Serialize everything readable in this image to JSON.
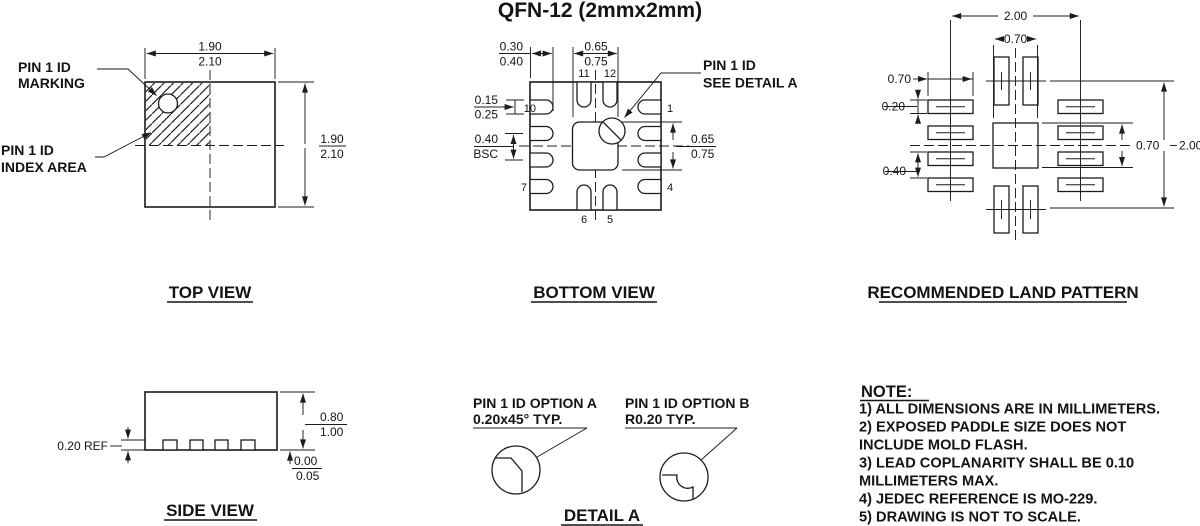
{
  "colors": {
    "ink": "#1c1c1c",
    "background": "#ffffff"
  },
  "title": "QFN-12 (2mmx2mm)",
  "top_view": {
    "title": "TOP VIEW",
    "width_min": "1.90",
    "width_max": "2.10",
    "height_min": "1.90",
    "height_max": "2.10",
    "marking_label_1": "PIN 1 ID",
    "marking_label_2": "MARKING",
    "index_label_1": "PIN 1 ID",
    "index_label_2": "INDEX AREA"
  },
  "bottom_view": {
    "title": "BOTTOM VIEW",
    "lead_length_min": "0.30",
    "lead_length_max": "0.40",
    "epad_width_min": "0.65",
    "epad_width_max": "0.75",
    "lead_width_min": "0.15",
    "lead_width_max": "0.25",
    "pitch_value": "0.40",
    "pitch_qualifier": "BSC",
    "epad_height_min": "0.65",
    "epad_height_max": "0.75",
    "pin1_label_1": "PIN 1 ID",
    "pin1_label_2": "SEE DETAIL A",
    "pins": {
      "n1": "1",
      "n4": "4",
      "n5": "5",
      "n6": "6",
      "n7": "7",
      "n10": "10",
      "n11": "11",
      "n12": "12"
    }
  },
  "land_pattern": {
    "title": "RECOMMENDED LAND PATTERN",
    "horizontal_span": "2.00",
    "center_pad_width": "0.70",
    "pad_length": "0.70",
    "pad_width": "0.20",
    "pitch": "0.40",
    "center_pad_height": "0.70",
    "vertical_span": "2.00"
  },
  "side_view": {
    "title": "SIDE VIEW",
    "lead_thickness": "0.20 REF",
    "height_min": "0.80",
    "height_max": "1.00",
    "standoff_min": "0.00",
    "standoff_max": "0.05"
  },
  "detail_a": {
    "title": "DETAIL A",
    "option_a_1": "PIN 1 ID OPTION A",
    "option_a_2": "0.20x45° TYP.",
    "option_b_1": "PIN 1 ID OPTION B",
    "option_b_2": "R0.20 TYP."
  },
  "notes": {
    "heading": "NOTE:",
    "lines": [
      "1) ALL DIMENSIONS ARE IN MILLIMETERS.",
      "2) EXPOSED PADDLE SIZE DOES NOT",
      "INCLUDE MOLD FLASH.",
      "3) LEAD COPLANARITY SHALL BE 0.10",
      "MILLIMETERS MAX.",
      "4) JEDEC REFERENCE IS MO-229.",
      "5) DRAWING IS NOT TO SCALE."
    ]
  }
}
